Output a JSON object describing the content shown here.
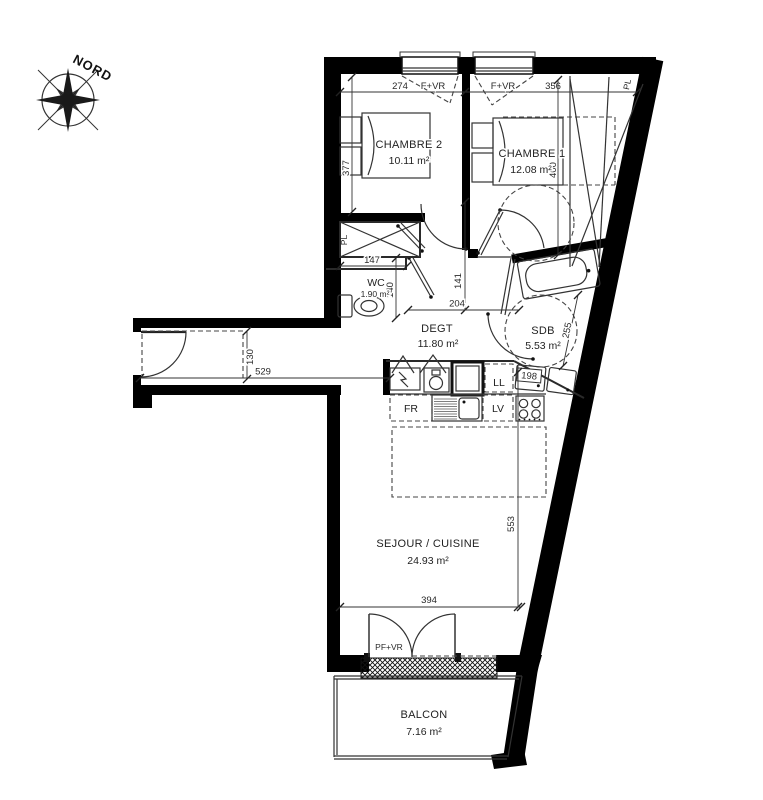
{
  "compass": {
    "north_label": "NORD"
  },
  "rooms": {
    "chambre2": {
      "name": "CHAMBRE 2",
      "area": "10.11 m²"
    },
    "chambre1": {
      "name": "CHAMBRE 1",
      "area": "12.08 m²"
    },
    "wc": {
      "name": "WC",
      "area": "1.90 m²"
    },
    "degt": {
      "name": "DEGT",
      "area": "11.80 m²"
    },
    "sdb": {
      "name": "SDB",
      "area": "5.53 m²"
    },
    "sejour": {
      "name": "SEJOUR / CUISINE",
      "area": "24.93 m²"
    },
    "balcon": {
      "name": "BALCON",
      "area": "7.16 m²"
    }
  },
  "openings": {
    "window_chambre2": "F+VR",
    "window_chambre1": "F+VR",
    "french_door": "PF+VR"
  },
  "closets": {
    "chambre1_closet": "PL",
    "degt_closet": "PL"
  },
  "appliances": {
    "fridge": "FR",
    "dishwasher": "LV",
    "washer": "LL"
  },
  "dims": {
    "chambre2_width": "274",
    "chambre1_width": "356",
    "chambre2_depth": "377",
    "chambre1_depth": "400",
    "wc_width": "147",
    "wc_depth": "140",
    "degt_width": "204",
    "degt_depth": "141",
    "sdb_width": "198",
    "sdb_depth": "255",
    "entry_length": "529",
    "entry_width": "130",
    "sejour_width": "394",
    "sejour_depth": "553"
  }
}
